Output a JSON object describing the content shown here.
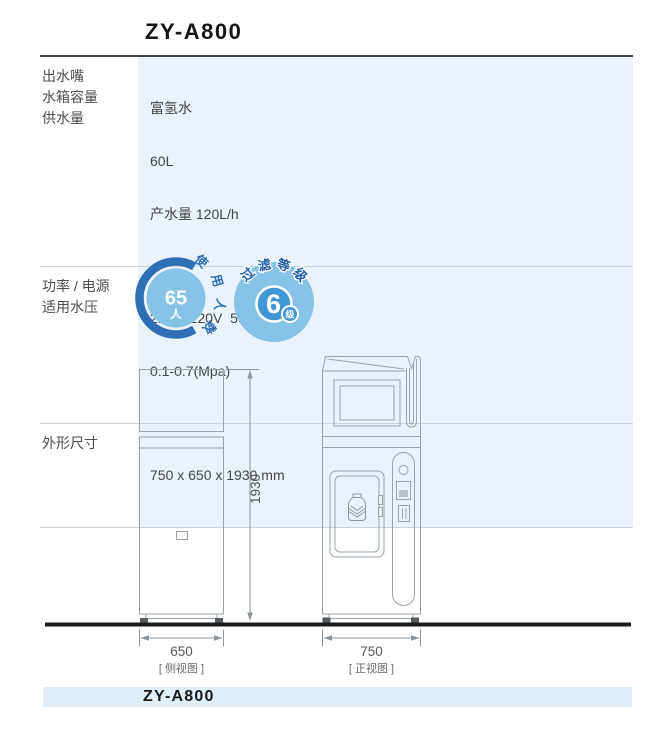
{
  "header": {
    "model": "ZY-A800"
  },
  "spec_table": {
    "rows": [
      {
        "labels": [
          "出水嘴",
          "水箱容量",
          "供水量"
        ],
        "values": [
          "富氢水",
          "60L",
          "产水量 120L/h"
        ]
      },
      {
        "labels": [
          "功率 / 电源",
          "适用水压"
        ],
        "values": [
          "2kW / 220V  50Hz",
          "0.1-0.7(Mpa)"
        ]
      },
      {
        "labels": [
          "外形尺寸"
        ],
        "values": [
          "750 x 650 x 1930 mm"
        ]
      }
    ]
  },
  "badges": [
    {
      "arc_label": "使用人数",
      "value": "65",
      "unit": "人"
    },
    {
      "arc_label": "过滤等级",
      "value": "6",
      "unit": "级"
    }
  ],
  "drawings": {
    "height_dim": "1930",
    "side": {
      "width_dim": "650",
      "caption": "[ 侧视图 ]"
    },
    "front": {
      "width_dim": "750",
      "caption": "[ 正视图 ]"
    }
  },
  "footer": {
    "model": "ZY-A800"
  },
  "colors": {
    "table_value_bg": "#eaf3fb",
    "footer_band_bg": "#e0eefa",
    "badge_ring_blue": "#2e6fb6",
    "badge_light_blue": "#85c3e9",
    "badge_disc_blue": "#3f98d5",
    "badge_arc_text_blue": "#1e5fa8",
    "drawing_stroke": "#9aa3ab",
    "ground_line": "#1c1c1c"
  }
}
